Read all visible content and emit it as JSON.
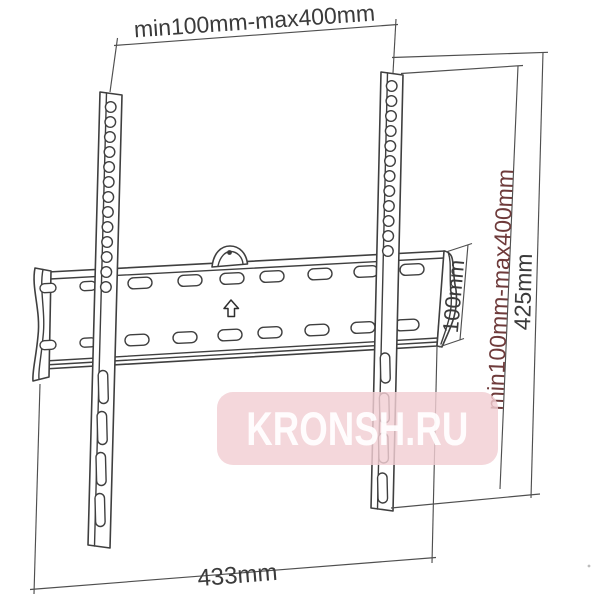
{
  "watermark": {
    "text": "KRONSH.RU",
    "band_color": "#f2ced3",
    "text_color": "#ffffff"
  },
  "dimensions": {
    "vesa_width": {
      "label": "min100mm-max400mm"
    },
    "plate_width": {
      "label": "433mm"
    },
    "plate_height": {
      "label": "100mm"
    },
    "vesa_height": {
      "label": "min100mm-max400mm"
    },
    "rail_height": {
      "label": "425mm"
    }
  },
  "colors": {
    "background": "#ffffff",
    "outline": "#3f3f3f",
    "dimension_line": "#4f4f4f",
    "label_text": "#3b3b3b",
    "vesa_height_label_text": "#6e3a3a"
  }
}
